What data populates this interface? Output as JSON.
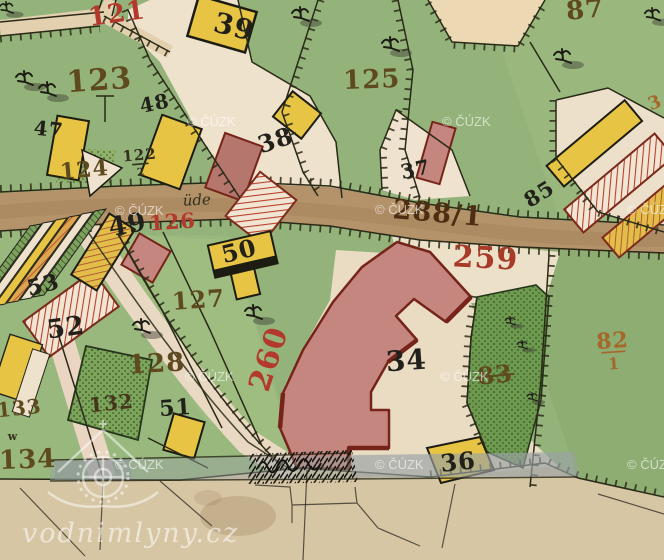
{
  "map": {
    "type": "historic-cadastral-map",
    "colors": {
      "red": "#b2392b",
      "red2": "#a83a28",
      "maroon": "#4d2e12",
      "brown": "#5f4a20",
      "sienna": "#a5682a",
      "black": "#22201a",
      "dark": "#34301e",
      "dark2": "#45351a",
      "baseGreen": "#94b37a",
      "darkGreenParcel": "#6e9a50",
      "road": "#b5936a",
      "paper": "#d7c6a4",
      "yellowBuilding": "#e7c443",
      "pinkBuilding": "#c4867f",
      "buildingOutlineRed": "#76241a",
      "hatchRed": "#b8412c",
      "watermark": "rgba(255,255,255,0.6)"
    },
    "labels": [
      {
        "text": "121",
        "x": 118,
        "y": 22,
        "s": 26,
        "c": "red",
        "r": -8
      },
      {
        "text": "39",
        "x": 232,
        "y": 36,
        "s": 28,
        "c": "black",
        "r": 14
      },
      {
        "text": "87",
        "x": 586,
        "y": 18,
        "s": 26,
        "c": "brown",
        "r": -6
      },
      {
        "text": "123",
        "x": 100,
        "y": 90,
        "s": 30,
        "c": "brown",
        "r": -4
      },
      {
        "text": "125",
        "x": 372,
        "y": 88,
        "s": 26,
        "c": "brown",
        "r": -2
      },
      {
        "text": "48",
        "x": 156,
        "y": 110,
        "s": 20,
        "c": "black",
        "r": -12
      },
      {
        "text": "38",
        "x": 278,
        "y": 148,
        "s": 24,
        "c": "black",
        "r": -18
      },
      {
        "text": "47",
        "x": 48,
        "y": 136,
        "s": 20,
        "c": "black",
        "r": 6
      },
      {
        "text": "122",
        "x": 140,
        "y": 160,
        "s": 15,
        "c": "dark",
        "r": -5,
        "den": "2"
      },
      {
        "text": "124",
        "x": 85,
        "y": 177,
        "s": 22,
        "c": "brown",
        "r": -5
      },
      {
        "text": "üde",
        "x": 197,
        "y": 205,
        "s": 15,
        "c": "dark",
        "r": -3,
        "italic": true
      },
      {
        "text": "126",
        "x": 173,
        "y": 229,
        "s": 21,
        "c": "red",
        "r": -4
      },
      {
        "text": "49",
        "x": 129,
        "y": 233,
        "s": 26,
        "c": "black",
        "r": -10
      },
      {
        "text": "288/1",
        "x": 437,
        "y": 222,
        "s": 27,
        "c": "maroon",
        "r": 5
      },
      {
        "text": "259",
        "x": 485,
        "y": 268,
        "s": 30,
        "c": "red2",
        "r": 3
      },
      {
        "text": "50",
        "x": 241,
        "y": 259,
        "s": 24,
        "c": "black",
        "r": -14
      },
      {
        "text": "53",
        "x": 45,
        "y": 292,
        "s": 22,
        "c": "black",
        "r": -14
      },
      {
        "text": "127",
        "x": 199,
        "y": 308,
        "s": 24,
        "c": "brown",
        "r": -4
      },
      {
        "text": "52",
        "x": 67,
        "y": 336,
        "s": 26,
        "c": "black",
        "r": -8
      },
      {
        "text": "85",
        "x": 543,
        "y": 200,
        "s": 21,
        "c": "black",
        "r": -32
      },
      {
        "text": "37",
        "x": 417,
        "y": 176,
        "s": 20,
        "c": "black",
        "r": -12
      },
      {
        "text": "128",
        "x": 157,
        "y": 372,
        "s": 26,
        "c": "brown",
        "r": -3
      },
      {
        "text": "132",
        "x": 112,
        "y": 410,
        "s": 20,
        "c": "dark2",
        "r": -6
      },
      {
        "text": "51",
        "x": 176,
        "y": 415,
        "s": 22,
        "c": "black",
        "r": -4
      },
      {
        "text": "133",
        "x": 20,
        "y": 415,
        "s": 20,
        "c": "brown",
        "r": -6
      },
      {
        "text": "134",
        "x": 28,
        "y": 468,
        "s": 26,
        "c": "brown",
        "r": -2
      },
      {
        "text": "260",
        "x": 278,
        "y": 362,
        "s": 30,
        "c": "red",
        "r": -72
      },
      {
        "text": "34",
        "x": 407,
        "y": 370,
        "s": 28,
        "c": "black",
        "r": -4
      },
      {
        "text": "83",
        "x": 496,
        "y": 383,
        "s": 24,
        "c": "brown",
        "r": -6,
        "strike": true
      },
      {
        "text": "82",
        "x": 613,
        "y": 348,
        "s": 22,
        "c": "sienna",
        "r": -4,
        "den": "1"
      },
      {
        "text": "36",
        "x": 459,
        "y": 470,
        "s": 24,
        "c": "black",
        "r": -6
      },
      {
        "text": "w",
        "x": 13,
        "y": 440,
        "s": 11,
        "c": "dark",
        "r": 0
      },
      {
        "text": "3",
        "x": 657,
        "y": 108,
        "s": 18,
        "c": "sienna",
        "r": -20
      }
    ],
    "watermark_cuzk": {
      "text": "© ČÚZK",
      "positions": [
        [
          187,
          126
        ],
        [
          442,
          126
        ],
        [
          115,
          215
        ],
        [
          375,
          214
        ],
        [
          627,
          214
        ],
        [
          185,
          381
        ],
        [
          440,
          381
        ],
        [
          115,
          469
        ],
        [
          375,
          469
        ],
        [
          627,
          469
        ]
      ]
    },
    "watermark_site": {
      "text": "vodnimlyny.cz"
    },
    "trees": [
      [
        6,
        9,
        0.8
      ],
      [
        24,
        80,
        1
      ],
      [
        47,
        91,
        1
      ],
      [
        300,
        16,
        1
      ],
      [
        390,
        46,
        1
      ],
      [
        562,
        58,
        1
      ],
      [
        652,
        16,
        0.9
      ],
      [
        141,
        328,
        1
      ],
      [
        253,
        314,
        1
      ],
      [
        510,
        322,
        0.6
      ],
      [
        522,
        346,
        0.6
      ],
      [
        532,
        398,
        0.6
      ]
    ]
  }
}
